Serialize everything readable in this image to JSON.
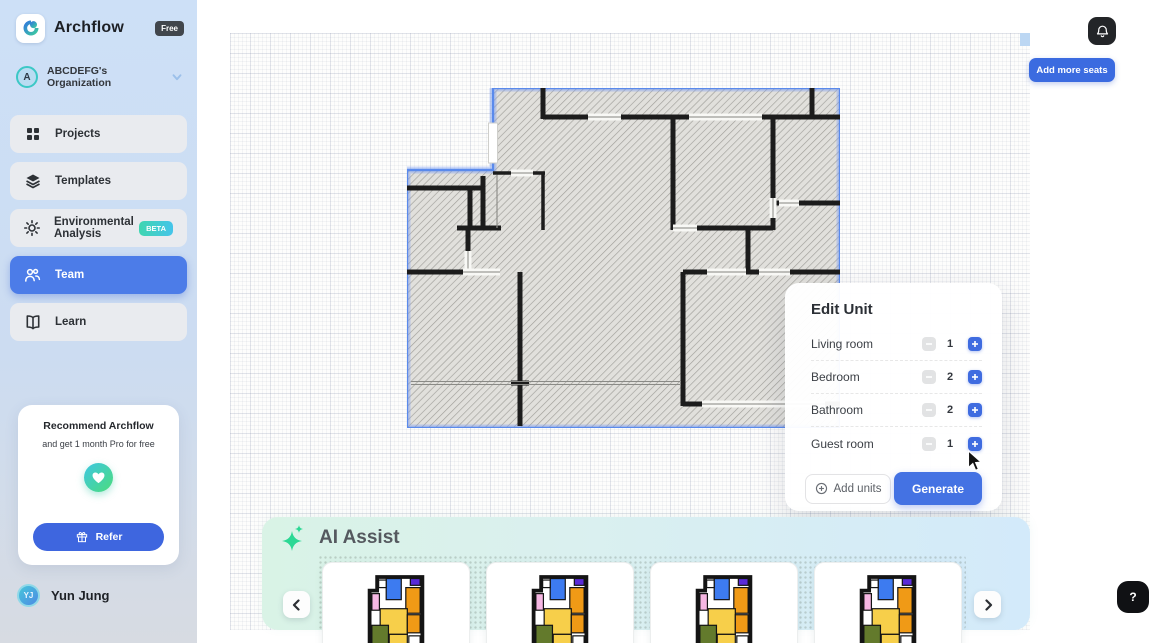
{
  "app": {
    "name": "Archflow",
    "plan_badge": "Free"
  },
  "org": {
    "avatar_initial": "A",
    "name": "ABCDEFG's  Organization"
  },
  "sidebar": {
    "items": [
      {
        "label": "Projects"
      },
      {
        "label": "Templates"
      },
      {
        "label": "Environmental Analysis",
        "badge": "BETA"
      },
      {
        "label": "Team"
      },
      {
        "label": "Learn"
      }
    ]
  },
  "referral": {
    "title": "Recommend Archflow",
    "subtitle": "and get 1 month Pro for free",
    "button_label": "Refer"
  },
  "user": {
    "initials": "YJ",
    "name": "Yun Jung"
  },
  "topbar": {
    "add_seats_label": "Add more seats"
  },
  "edit_unit": {
    "title": "Edit Unit",
    "rows": [
      {
        "label": "Living room",
        "count": "1"
      },
      {
        "label": "Bedroom",
        "count": "2"
      },
      {
        "label": "Bathroom",
        "count": "2"
      },
      {
        "label": "Guest room",
        "count": "1"
      }
    ],
    "add_units_label": "Add units",
    "generate_label": "Generate"
  },
  "ai_assist": {
    "title": "AI Assist",
    "thumbnail_count": "4"
  },
  "help": {
    "label": "?"
  },
  "colors": {
    "accent_blue": "#3f6ce0",
    "active_nav_blue": "#4c7ce8",
    "selection_blue": "#5a8aec",
    "beta_gradient": "#3fd6b0 → #45c4ea",
    "ai_panel_gradient": "#d9f3e6 → #d3eafa",
    "brand_teal": "#3cc8c6"
  }
}
